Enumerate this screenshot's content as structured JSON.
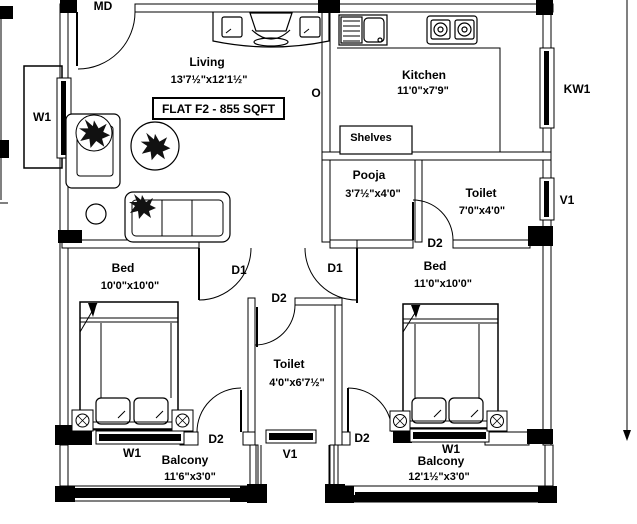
{
  "plan": {
    "title": "FLAT F2 - 855 SQFT",
    "rooms": {
      "living": {
        "name": "Living",
        "size": "13'7½\"x12'1½\""
      },
      "kitchen": {
        "name": "Kitchen",
        "size": "11'0\"x7'9\""
      },
      "pooja": {
        "name": "Pooja",
        "size": "3'7½\"x4'0\""
      },
      "toilet_attached": {
        "name": "Toilet",
        "size": "7'0\"x4'0\""
      },
      "bed_left": {
        "name": "Bed",
        "size": "10'0\"x10'0\""
      },
      "bed_right": {
        "name": "Bed",
        "size": "11'0\"x10'0\""
      },
      "toilet_common": {
        "name": "Toilet",
        "size": "4'0\"x6'7½\""
      },
      "balcony_left": {
        "name": "Balcony",
        "size": "11'6\"x3'0\""
      },
      "balcony_right": {
        "name": "Balcony",
        "size": "12'1½\"x3'0\""
      },
      "shelves": {
        "name": "Shelves"
      }
    },
    "markers": {
      "main_door": "MD",
      "opening": "O",
      "kitchen_window": "KW1",
      "ventilator": "V1",
      "window": "W1",
      "door1": "D1",
      "door2": "D2"
    },
    "colors": {
      "line": "#000000",
      "background": "#ffffff"
    }
  }
}
